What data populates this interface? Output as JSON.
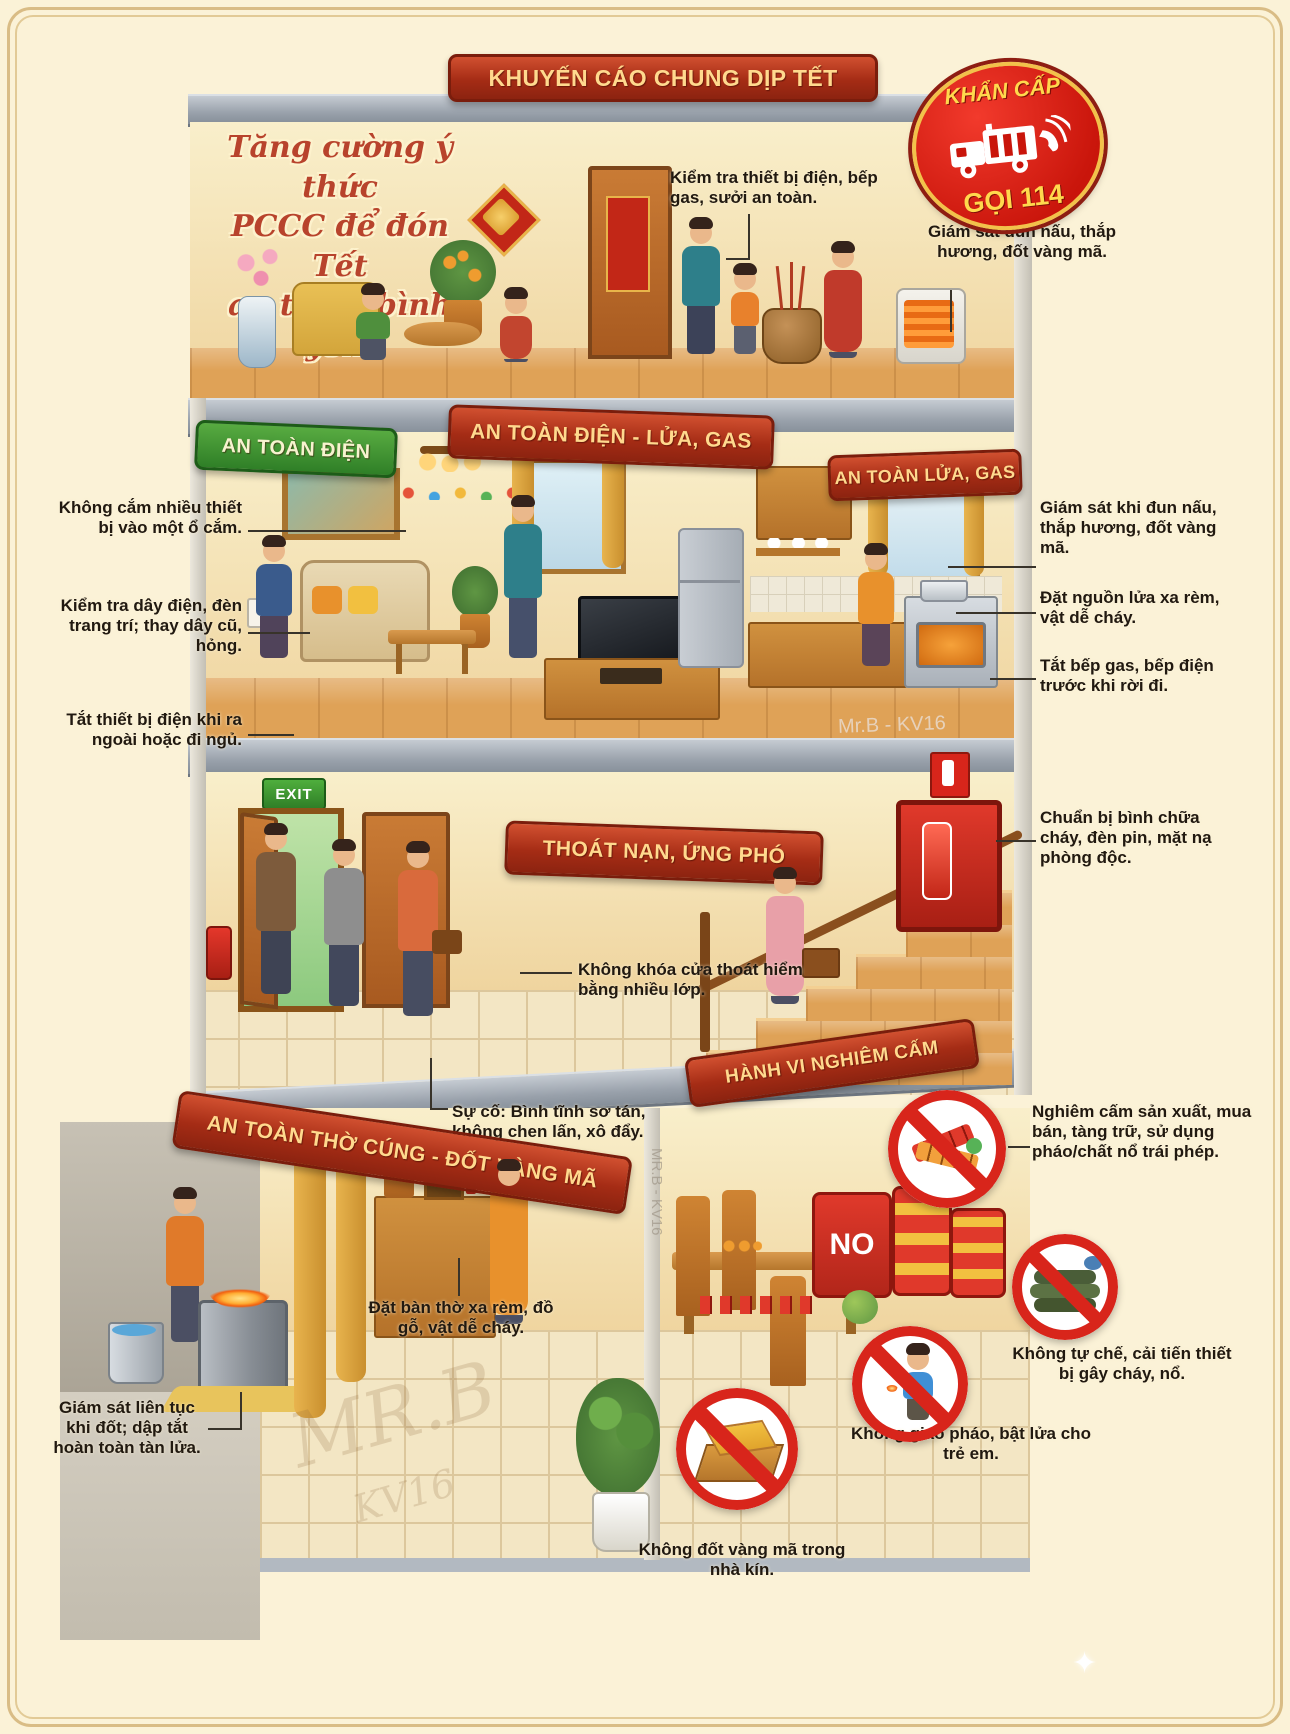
{
  "header": {
    "title": "KHUYẾN CÁO CHUNG DỊP TẾT"
  },
  "badge": {
    "top": "KHẨN CẤP",
    "call": "GỌI 114"
  },
  "floor1": {
    "slogan_line1": "Tăng cường ý thức",
    "slogan_line2": "PCCC để đón Tết",
    "slogan_line3": "an toàn, bình yên.",
    "callout_check": "Kiểm tra thiết bị điện, bếp gas, sưởi an toàn.",
    "callout_watch": "Giám sát đun nấu, thắp hương, đốt vàng mã."
  },
  "floor2": {
    "banner_left": "AN TOÀN ĐIỆN",
    "banner_center": "AN TOÀN ĐIỆN - LỬA, GAS",
    "banner_right": "AN TOÀN LỬA, GAS",
    "left_callouts": [
      "Không cắm nhiều thiết bị vào một ổ cắm.",
      "Kiểm tra dây điện, đèn trang trí; thay dây cũ, hỏng.",
      "Tắt thiết bị điện khi ra ngoài hoặc đi ngủ."
    ],
    "right_callouts": [
      "Giám sát khi đun nấu, thắp hương, đốt vàng mã.",
      "Đặt nguồn lửa xa rèm, vật dễ cháy.",
      "Tắt bếp gas, bếp điện trước khi rời đi."
    ]
  },
  "floor3": {
    "banner": "THOÁT NẠN, ỨNG PHÓ",
    "exit_sign": "EXIT",
    "callout_door": "Không khóa cửa thoát hiểm bằng nhiều lớp.",
    "callout_kit": "Chuẩn bị bình chữa cháy, đèn pin, mặt nạ phòng độc.",
    "callout_evac": "Sự cố: Bình tĩnh sơ tán, không chen lấn, xô đẩy."
  },
  "floor4": {
    "banner_left": "AN TOÀN THỜ CÚNG - ĐỐT VÀNG MÃ",
    "banner_right": "HÀNH VI NGHIÊM CẤM",
    "callout_altar": "Đặt bàn thờ xa rèm, đồ gỗ, vật dễ cháy.",
    "callout_burn": "Giám sát liên tục khi đốt; dập tắt hoàn toàn tàn lửa.",
    "ban_fireworks": "Nghiêm cấm sản xuất, mua bán, tàng trữ, sử dụng pháo/chất nổ trái phép.",
    "ban_homemade": "Không tự chế, cải tiến thiết bị gây cháy, nổ.",
    "ban_children": "Không giao pháo, bật lửa cho trẻ em.",
    "ban_indoor": "Không đốt vàng mã trong nhà kín.",
    "barrel_label": "NO"
  },
  "watermarks": {
    "w1": "Mr.B - KV16",
    "w2": "MR.B - KV16",
    "w3": "MR.B",
    "w4": "KV16"
  },
  "colors": {
    "banner_red": "#a52c15",
    "banner_green": "#2f7f27",
    "badge_red": "#e0261b",
    "accent_yellow": "#ffd98e",
    "text": "#211910"
  }
}
